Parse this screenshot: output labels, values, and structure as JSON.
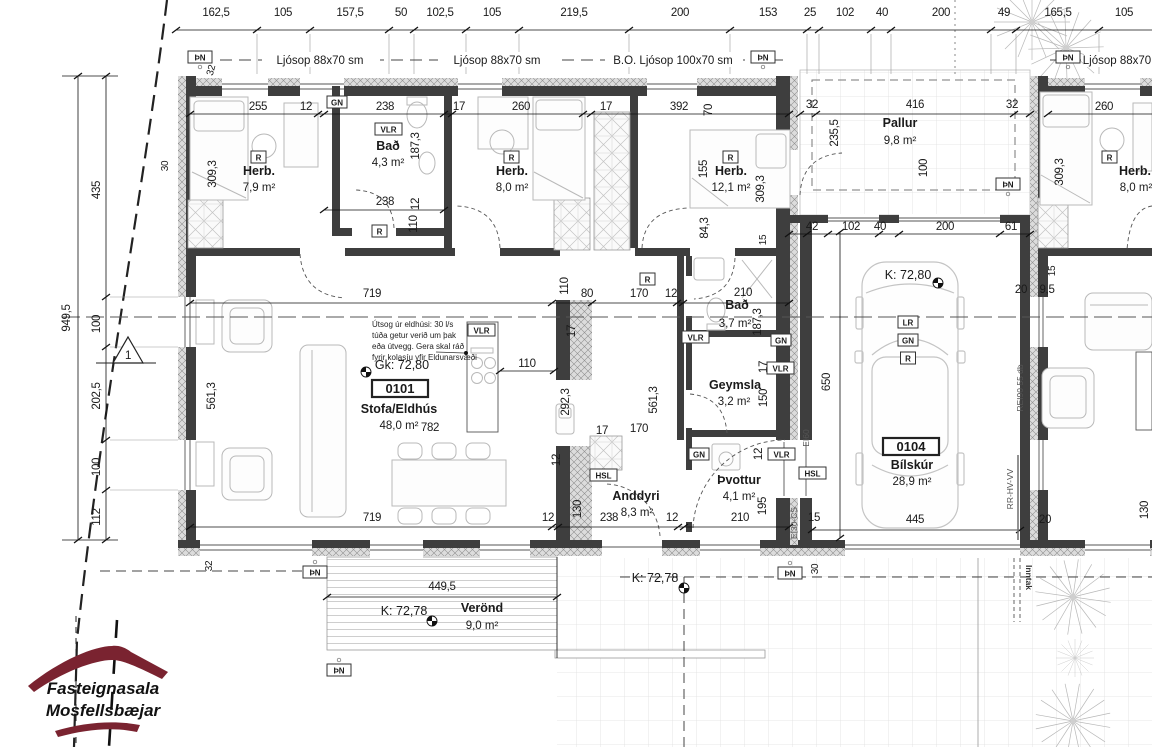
{
  "logo": {
    "line1": "Fasteignasala",
    "line2": "Mosfellsbæjar",
    "color": "#7a2330"
  },
  "section_marker": "1",
  "badges": {
    "pn": "ÞN",
    "gn": "GN",
    "vlr": "VLR",
    "r": "R",
    "lr": "LR",
    "hsl": "HSL"
  },
  "window_labels": {
    "w1": "Ljósop 88x70 sm",
    "w2": "Ljósop 88x70 sm",
    "w3": "B.O. Ljósop 100x70 sm",
    "w4": "Ljósop 88x70"
  },
  "levels": {
    "gk_stofa": "Gk: 72,80",
    "k_garage": "K: 72,80",
    "k_verond": "K: 72,78",
    "k_lot": "K: 72,78"
  },
  "annotations": {
    "kitchen_note": {
      "l1": "Útsog úr eldhúsi: 30 l/s",
      "l2": "túða getur verið um þak",
      "l3": "eða útvegg. Gera skal ráð",
      "l4": "fyrir kolasíu yfir Eldunarsvæði"
    },
    "inntak": "Inntak",
    "rei90": "REI90 55 db",
    "rr_hv_vv": "RR-HV-VV",
    "ei60": "EI60",
    "ei30cs": "EI30-CS"
  },
  "rooms": {
    "herb1": {
      "badge": "R",
      "name": "Herb.",
      "area": "7,9 m²"
    },
    "bad1": {
      "badge": "VLR",
      "name": "Bað",
      "area": "4,3 m²"
    },
    "herb2": {
      "badge": "R",
      "name": "Herb.",
      "area": "8,0 m²"
    },
    "herb3": {
      "badge": "R",
      "name": "Herb.",
      "area": "12,1 m²"
    },
    "pallur": {
      "name": "Pallur",
      "area": "9,8 m²"
    },
    "stofa": {
      "id": "0101",
      "name": "Stofa/Eldhús",
      "area": "48,0 m²"
    },
    "bad2": {
      "name": "Bað",
      "area": "3,7 m²"
    },
    "geymsla": {
      "name": "Geymsla",
      "area": "3,2 m²"
    },
    "thvottur": {
      "name": "Þvottur",
      "area": "4,1 m²"
    },
    "anddyri": {
      "name": "Anddyri",
      "area": "8,3 m²"
    },
    "bilskur": {
      "id": "0104",
      "name": "Bílskúr",
      "area": "28,9 m²"
    },
    "verond": {
      "name": "Verönd",
      "area": "9,0 m²"
    },
    "herb4": {
      "badge": "R",
      "name": "Herb.",
      "area": "8,0 m²"
    }
  },
  "dims": {
    "top": [
      "162,5",
      "105",
      "157,5",
      "50",
      "102,5",
      "105",
      "219,5",
      "200",
      "153",
      "25",
      "102",
      "40",
      "200",
      "49",
      "165,5",
      "105"
    ],
    "left_overall": "949,5",
    "left": [
      "435",
      "100",
      "202,5",
      "100",
      "112"
    ],
    "d": {
      "n12": "12",
      "n15": "15",
      "n17": "17",
      "n20": "20",
      "n30": "30",
      "n32": "32",
      "n40": "40",
      "n42": "42",
      "n61": "61",
      "n70": "70",
      "n80": "80",
      "n95": "9,5",
      "n100": "100",
      "n102": "102",
      "n110": "110",
      "n130": "130",
      "n150": "150",
      "n155": "155",
      "n170": "170",
      "n187_3": "187,3",
      "n195": "195",
      "n200": "200",
      "n210": "210",
      "n235_5": "235,5",
      "n238": "238",
      "n255": "255",
      "n260": "260",
      "n292_3": "292,3",
      "n309_3": "309,3",
      "n392": "392",
      "n416": "416",
      "n445": "445",
      "n449_5": "449,5",
      "n561_3": "561,3",
      "n650": "650",
      "n719": "719",
      "n782": "782",
      "n84_3": "84,3"
    }
  }
}
